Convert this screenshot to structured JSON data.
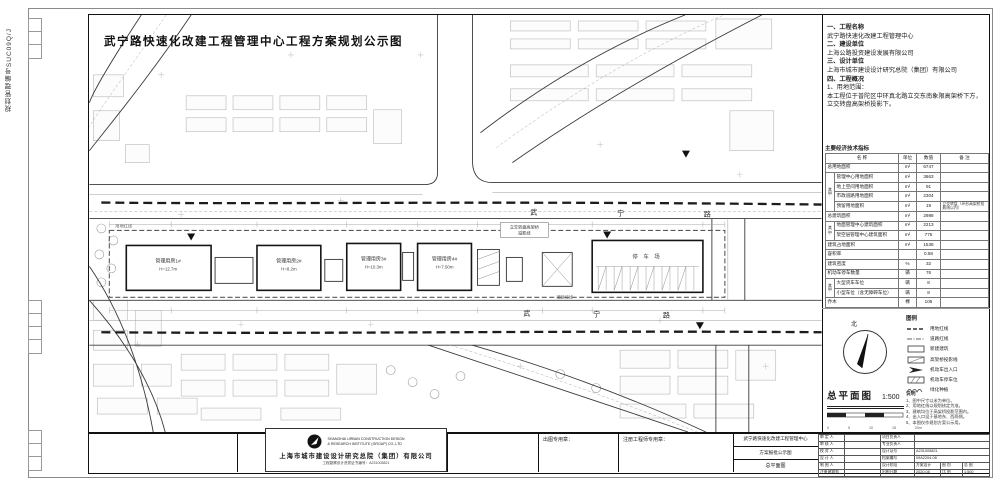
{
  "sheet": {
    "side_code": "规划管理编号SUC09Q/J",
    "title": "武宁路快速化改建工程管理中心工程方案规划公示图"
  },
  "info_panel": {
    "lines": [
      "一、工程名称",
      "武宁路快速化改建工程管理中心",
      "二、建设单位",
      "上海公路投资建设发展有限公司",
      "三、设计单位",
      "上海市城市建设设计研究总院（集团）有限公司",
      "四、工程概况",
      "1、用地范围：",
      "本工程位于普陀区中环真北路立交东南象限高架桥下方，立交转盘高架桥投影下。"
    ]
  },
  "indicator_table": {
    "title": "主要经济技术指标",
    "columns": [
      "名  称",
      "单位",
      "数值",
      "备  注"
    ],
    "group_label": "其中",
    "rows": [
      {
        "name": "总用地面积",
        "unit": "m²",
        "value": "6747",
        "note": "",
        "group": 0
      },
      {
        "name": "管理中心用地面积",
        "unit": "m²",
        "value": "3663",
        "note": "",
        "group": 1
      },
      {
        "name": "地上空间用地面积",
        "unit": "m²",
        "value": "91",
        "note": "",
        "group": 1
      },
      {
        "name": "市政道路用地面积",
        "unit": "m²",
        "value": "2304",
        "note": "",
        "group": 1
      },
      {
        "name": "预留用地面积",
        "unit": "m²",
        "value": "19",
        "note": "立交转盘（环形高架桥投影线以内）",
        "group": 1
      },
      {
        "name": "总建筑面积",
        "unit": "m²",
        "value": "2988",
        "note": "",
        "group": 0
      },
      {
        "name": "地面管理中心建筑面积",
        "unit": "m²",
        "value": "2213",
        "note": "",
        "group": 2
      },
      {
        "name": "架空层管理中心建筑面积",
        "unit": "m²",
        "value": "775",
        "note": "",
        "group": 2
      },
      {
        "name": "建筑占地面积",
        "unit": "m²",
        "value": "1538",
        "note": "",
        "group": 0
      },
      {
        "name": "容积率",
        "unit": "",
        "value": "0.58",
        "note": "",
        "group": 0
      },
      {
        "name": "建筑密度",
        "unit": "%",
        "value": "32",
        "note": "",
        "group": 0
      },
      {
        "name": "机动车停车数量",
        "unit": "辆",
        "value": "76",
        "note": "",
        "group": 0
      },
      {
        "name": "大型货车车位",
        "unit": "辆",
        "value": "8",
        "note": "",
        "group": 3
      },
      {
        "name": "小型车位（含无障碍车位）",
        "unit": "辆",
        "value": "8",
        "note": "",
        "group": 3
      },
      {
        "name": "乔木",
        "unit": "棵",
        "value": "105",
        "note": "",
        "group": 0
      }
    ]
  },
  "plan": {
    "buildings": [
      {
        "name": "管理用房1#",
        "height": "H=12.7m"
      },
      {
        "name": "管理用房2#",
        "height": "H=8.2m"
      },
      {
        "name": "管理用房3#",
        "height": "H=10.3m"
      },
      {
        "name": "管理用房4#",
        "height": "H=7.50m"
      }
    ],
    "parking_label": "停 车 场",
    "road_name_chars": [
      "武",
      "宁",
      "路"
    ],
    "labels": {
      "ramp_projection_1": "立交转盘高架桥",
      "ramp_projection_2": "投影线",
      "road_red_line": "道路红线",
      "site_red_line": "用地红线"
    }
  },
  "north_arrow": {
    "label": "北"
  },
  "plan_title": {
    "label": "总平面图",
    "scale": "1:500"
  },
  "scale_bar": {
    "ticks": [
      "0",
      "5",
      "10",
      "15",
      "20m"
    ]
  },
  "legend": {
    "title": "图例",
    "items": [
      {
        "symbol": "dash-bold",
        "label": "用地红线"
      },
      {
        "symbol": "dashdot",
        "label": "道路红线"
      },
      {
        "symbol": "rect",
        "label": "新建建筑"
      },
      {
        "symbol": "rect-diag",
        "label": "高架桥投影线"
      },
      {
        "symbol": "arrow",
        "label": "机动车出入口"
      },
      {
        "symbol": "hatch-rect",
        "label": "机动车停车位"
      },
      {
        "symbol": "scallop",
        "label": "绿化种植"
      }
    ]
  },
  "notes": {
    "title": "说明",
    "items": [
      "1、图中尺寸以米为单位。",
      "2、用地红线以规划核定为准。",
      "3、建筑均位于高架桥投影范围内。",
      "4、出入口设于基地东、西两侧。",
      "5、本图仅作规划方案公示用。"
    ]
  },
  "title_block": {
    "seal_label": "出图专用章：",
    "engineer_seal_label": "注册工程师专用章：",
    "project_cells": [
      "武宁路快速化改建工程管理中心",
      "方案报批公示图",
      "总平面图"
    ],
    "company": {
      "en_line1": "SHANGHAI URBAN CONSTRUCTION DESIGN",
      "en_line2": "& RESEARCH INSTITUTE (GROUP) CO.,LTD",
      "cn_name": "上海市城市建设设计研究总院（集团）有限公司",
      "cert": "工程勘察设计资质证书编号：A231005821"
    },
    "sign_rows": [
      {
        "left": "审 定 人",
        "cells": [
          "项目负责人",
          ""
        ]
      },
      {
        "left": "审 核 人",
        "cells": [
          "专业负责人",
          ""
        ]
      },
      {
        "left": "校 对 人",
        "cells": [
          "设计证号",
          "A231005821"
        ]
      },
      {
        "left": "设 计 人",
        "cells": [
          "档案编号",
          "09A2204-08"
        ]
      },
      {
        "left": "制 图 人",
        "cells": [
          "设计阶段",
          "方案设计",
          "图 别",
          "总 图"
        ]
      },
      {
        "left": "注册建筑师",
        "cells": [
          "出图日期",
          "2020.08",
          "比 例",
          "1:500"
        ]
      }
    ]
  }
}
